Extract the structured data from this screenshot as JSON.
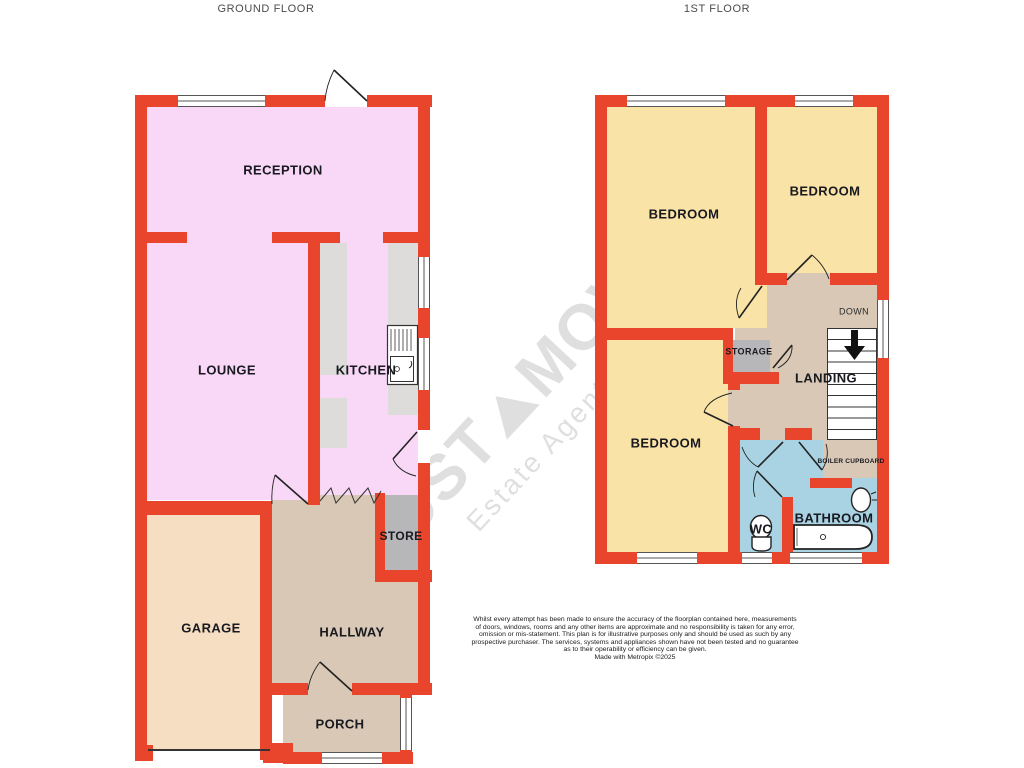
{
  "titles": {
    "ground_floor": "GROUND FLOOR",
    "first_floor": "1ST FLOOR"
  },
  "ground_floor": {
    "reception": "RECEPTION",
    "lounge": "LOUNGE",
    "kitchen": "KITCHEN",
    "store": "STORE",
    "garage": "GARAGE",
    "hallway": "HALLWAY",
    "porch": "PORCH"
  },
  "first_floor": {
    "bedroom_left": "BEDROOM",
    "bedroom_right": "BEDROOM",
    "bedroom_bottom": "BEDROOM",
    "storage": "STORAGE",
    "landing": "LANDING",
    "down": "DOWN",
    "boiler_cupboard": "BOILER CUPBOARD",
    "wc": "WC",
    "bathroom": "BATHROOM"
  },
  "watermark": {
    "brand_left": "JUST",
    "brand_right": "MOVE",
    "tagline": "Estate Agents & Lettings"
  },
  "disclaimer": {
    "lines": [
      "Whilst every attempt has been made to ensure the accuracy of the floorplan contained here, measurements",
      "of doors, windows, rooms and any other items are approximate and no responsibility is taken for any error,",
      "omission or mis-statement. This plan is for illustrative purposes only and should be used as such by any",
      "prospective purchaser. The services, systems and appliances shown have not been tested and no guarantee",
      "as to their operability or efficiency can be given.",
      "Made with Metropix ©2025"
    ]
  },
  "colors": {
    "wall": "#E8452C",
    "reception_rooms": "#F9D8F7",
    "bedrooms": "#F9E3A7",
    "hall_landing": "#D8C8B5",
    "garage": "#F6DEC3",
    "bathroom": "#A9D3E3",
    "storage": "#B7B7B9",
    "counter": "#DDDCDA"
  }
}
